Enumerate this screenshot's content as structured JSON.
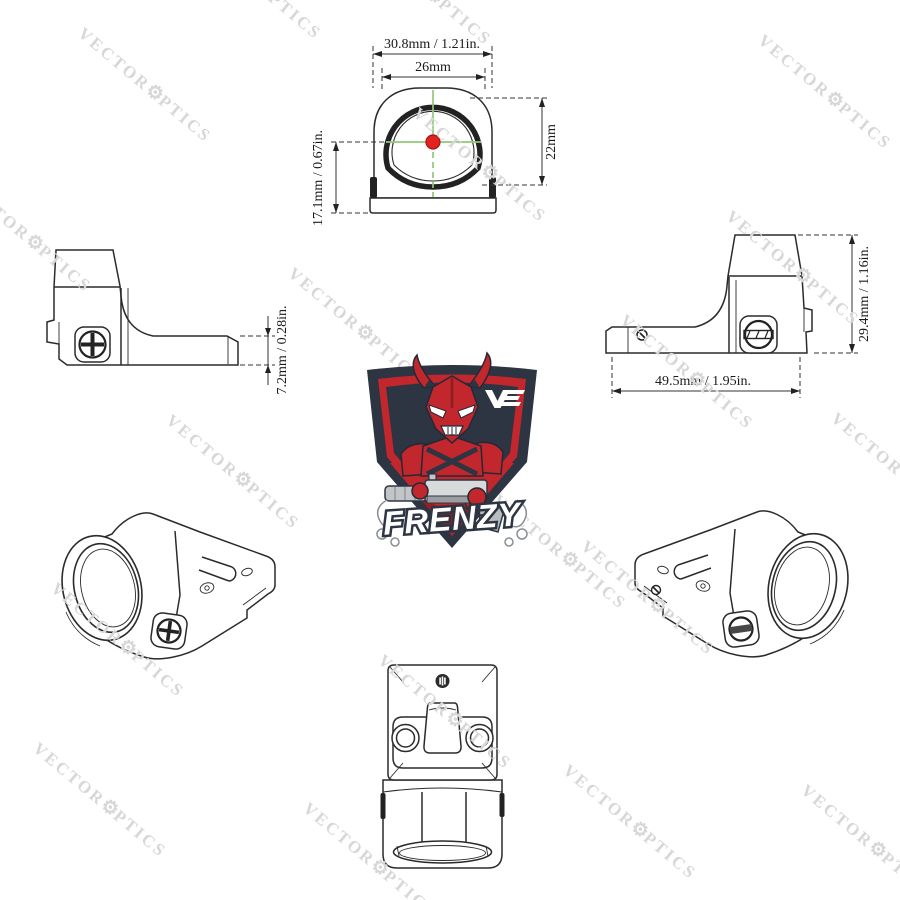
{
  "watermark": {
    "part1": "VECTOR",
    "gear": "⚙",
    "part2": "PTICS",
    "color": "#d7d7d7",
    "angle_deg": 40,
    "positions": [
      [
        145,
        85
      ],
      [
        825,
        92
      ],
      [
        480,
        165
      ],
      [
        25,
        235
      ],
      [
        793,
        268
      ],
      [
        355,
        325
      ],
      [
        687,
        372
      ],
      [
        233,
        472
      ],
      [
        560,
        552
      ],
      [
        118,
        640
      ],
      [
        898,
        470
      ],
      [
        445,
        712
      ],
      [
        648,
        598
      ],
      [
        100,
        800
      ],
      [
        370,
        860
      ],
      [
        630,
        822
      ],
      [
        868,
        842
      ],
      [
        255,
        -18
      ],
      [
        425,
        -12
      ]
    ]
  },
  "front_view": {
    "dims": {
      "outer_width": "30.8mm / 1.21in.",
      "window_width": "26mm",
      "window_height": "22mm",
      "optical_axis_height": "17.1mm / 0.67in."
    },
    "reticle": {
      "dot_color": "#e3211f",
      "crosshair_color": "#92c878"
    }
  },
  "left_side_view": {
    "dims": {
      "base_height": "7.2mm / 0.28in."
    }
  },
  "right_side_view": {
    "dims": {
      "overall_length": "49.5mm / 1.95in.",
      "overall_height": "29.4mm / 1.16in."
    }
  },
  "logo": {
    "name": "FRENZY",
    "brand_mark": "VE",
    "colors": {
      "shield_navy": "#2d3442",
      "red": "#c1272d",
      "dark_red": "#9e1b20",
      "white": "#ffffff",
      "gun_gray": "#c3c6c8"
    }
  }
}
